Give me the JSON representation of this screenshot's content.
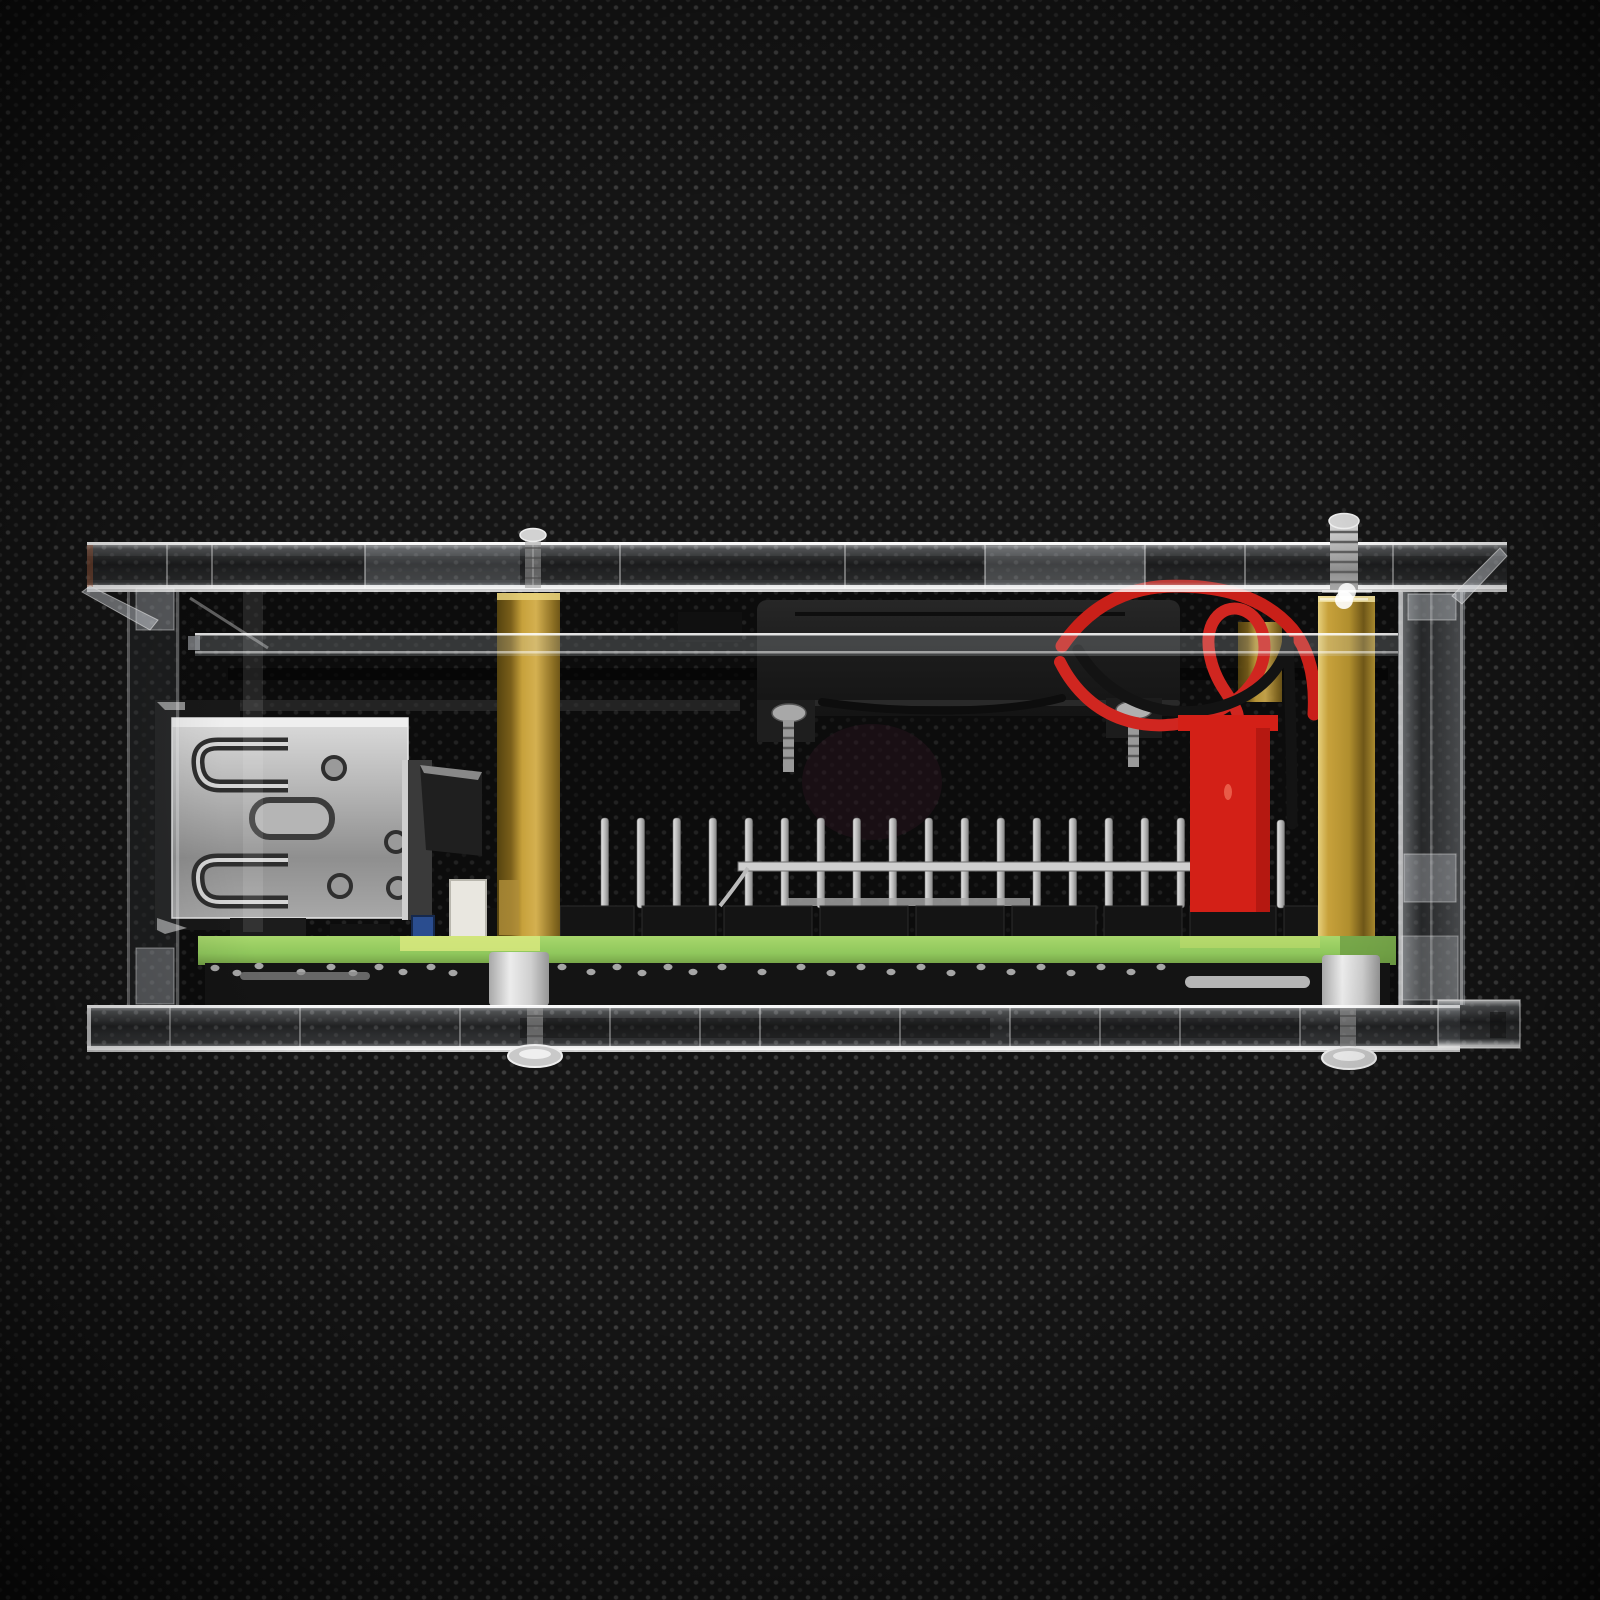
{
  "meta": {
    "description": "Side-view product photo: single-board computer with cooling fan inside a clear acrylic case, standing on black woven fabric",
    "visible_text": []
  },
  "palette": {
    "fabric_base": "#151515",
    "fabric_dot": "#6e6e6e",
    "acrylic_edge": "#ffffff",
    "acrylic_body": "rgba(215,224,232,0.16)",
    "brass": "#c7a13b",
    "brass_dark": "#6f5718",
    "brass_light": "#e6cf7c",
    "pcb_green": "#8fc75c",
    "pcb_glow": "#d8e87e",
    "wire_red": "#c92019",
    "wire_black": "#131313",
    "connector_red": "#d32017",
    "fan_black": "#1d1d1d",
    "metal": "#b5b5b5",
    "metal_bright": "#e8e8e8",
    "spacer_gray": "#d9d9d9",
    "plastic_black": "#141414"
  },
  "components": {
    "gpio_header": {
      "pin_count": 17,
      "x_start": 601,
      "x_step": 36,
      "pin_width": 7.5,
      "y_top": 818,
      "y_bottom": 908,
      "extra_pin_x": 1277
    },
    "base_segments": [
      [
        560,
        74
      ],
      [
        642,
        74
      ],
      [
        724,
        88
      ],
      [
        820,
        88
      ],
      [
        916,
        88
      ],
      [
        1012,
        84
      ],
      [
        1104,
        78
      ],
      [
        1190,
        86
      ],
      [
        1284,
        34
      ]
    ],
    "solder_dots": [
      [
        215,
        968
      ],
      [
        237,
        973
      ],
      [
        259,
        966
      ],
      [
        301,
        972
      ],
      [
        331,
        967
      ],
      [
        353,
        973
      ],
      [
        379,
        967
      ],
      [
        403,
        972
      ],
      [
        431,
        967
      ],
      [
        453,
        973
      ],
      [
        562,
        967
      ],
      [
        591,
        972
      ],
      [
        617,
        967
      ],
      [
        642,
        973
      ],
      [
        668,
        967
      ],
      [
        693,
        972
      ],
      [
        722,
        967
      ],
      [
        762,
        972
      ],
      [
        801,
        967
      ],
      [
        831,
        973
      ],
      [
        861,
        967
      ],
      [
        891,
        972
      ],
      [
        921,
        967
      ],
      [
        951,
        973
      ],
      [
        981,
        967
      ],
      [
        1011,
        972
      ],
      [
        1041,
        967
      ],
      [
        1071,
        973
      ],
      [
        1101,
        967
      ],
      [
        1131,
        972
      ],
      [
        1161,
        967
      ]
    ],
    "wires": [
      {
        "name": "fan-wire-red-upper",
        "color": "#c92019",
        "width": 13,
        "path": "M 1062,646 C 1092,602 1132,586 1176,586 C 1230,586 1268,601 1292,629 C 1310,651 1316,681 1314,714"
      },
      {
        "name": "fan-wire-red-loop",
        "color": "#d02620",
        "width": 12,
        "path": "M 1060,662 C 1090,722 1150,737 1205,717 C 1252,699 1272,662 1262,631 C 1254,607 1228,601 1215,619 C 1202,637 1210,669 1225,691 C 1233,703 1238,711 1238,718"
      },
      {
        "name": "fan-wire-black",
        "color": "#131313",
        "width": 11,
        "path": "M 1078,650 C 1110,704 1170,722 1222,706 C 1266,692 1287,661 1288,637 C 1290,692 1292,760 1292,824"
      },
      {
        "name": "fan-wire-black-under",
        "color": "#0d0d0d",
        "width": 8,
        "path": "M 822,702 C 902,714 1002,714 1062,698"
      }
    ]
  }
}
